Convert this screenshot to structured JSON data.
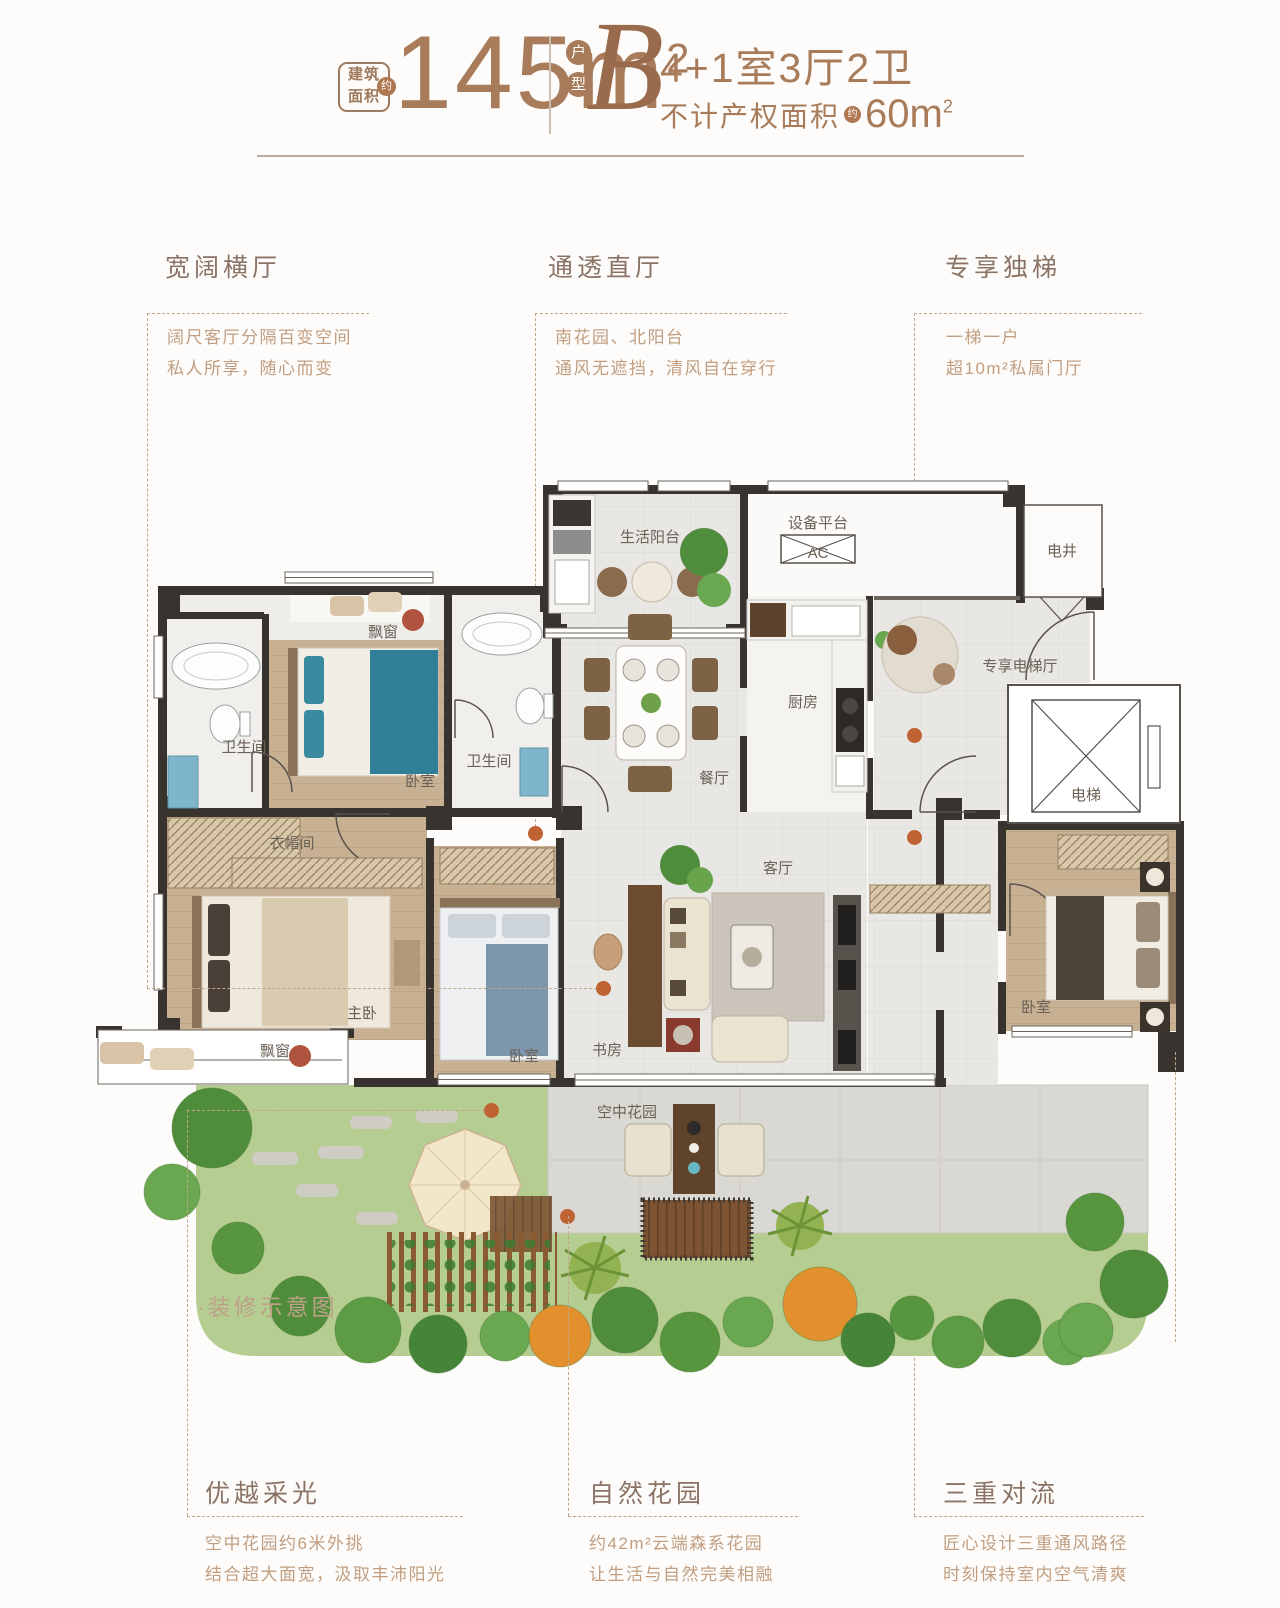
{
  "header": {
    "area_label_l1": "建筑",
    "area_label_l2": "面积",
    "approx_badge": "约",
    "area_value": "145m",
    "area_unit_sup": "2",
    "type_char_1": "户",
    "type_char_2": "型",
    "type_letter": "B",
    "spec": "4+1室3厅2卫",
    "note_prefix": "不计产权面积",
    "note_approx": "约",
    "note_value": "60m",
    "note_sup": "2"
  },
  "features_top": [
    {
      "title": "宽阔横厅",
      "desc1": "阔尺客厅分隔百变空间",
      "desc2": "私人所享，随心而变"
    },
    {
      "title": "通透直厅",
      "desc1": "南花园、北阳台",
      "desc2": "通风无遮挡，清风自在穿行"
    },
    {
      "title": "专享独梯",
      "desc1": "一梯一户",
      "desc2": "超10m²私属门厅"
    }
  ],
  "features_bottom": [
    {
      "title": "优越采光",
      "desc1": "空中花园约6米外挑",
      "desc2": "结合超大面宽，汲取丰沛阳光"
    },
    {
      "title": "自然花园",
      "desc1": "约42m²云端森系花园",
      "desc2": "让生活与自然完美相融"
    },
    {
      "title": "三重对流",
      "desc1": "匠心设计三重通风路径",
      "desc2": "时刻保持室内空气清爽"
    }
  ],
  "plan": {
    "note": "·装修示意图",
    "rooms": {
      "life_balcony": "生活阳台",
      "equipment": "设备平台",
      "ac": "AC",
      "shaft": "电井",
      "bath1": "卫生间",
      "bay1": "飘窗",
      "bedroom1": "卧室",
      "bath2": "卫生间",
      "dining": "餐厅",
      "kitchen": "厨房",
      "lift_hall": "专享电梯厅",
      "lift": "电梯",
      "cloak": "衣帽间",
      "master": "主卧",
      "bay2": "飘窗",
      "bedroom2": "卧室",
      "study": "书房",
      "living": "客厅",
      "bedroom3": "卧室",
      "garden": "空中花园"
    }
  },
  "colors": {
    "accent": "#a87c5a",
    "wall": "#38332e",
    "leader": "#bda68c",
    "dot": "#bf6334"
  }
}
